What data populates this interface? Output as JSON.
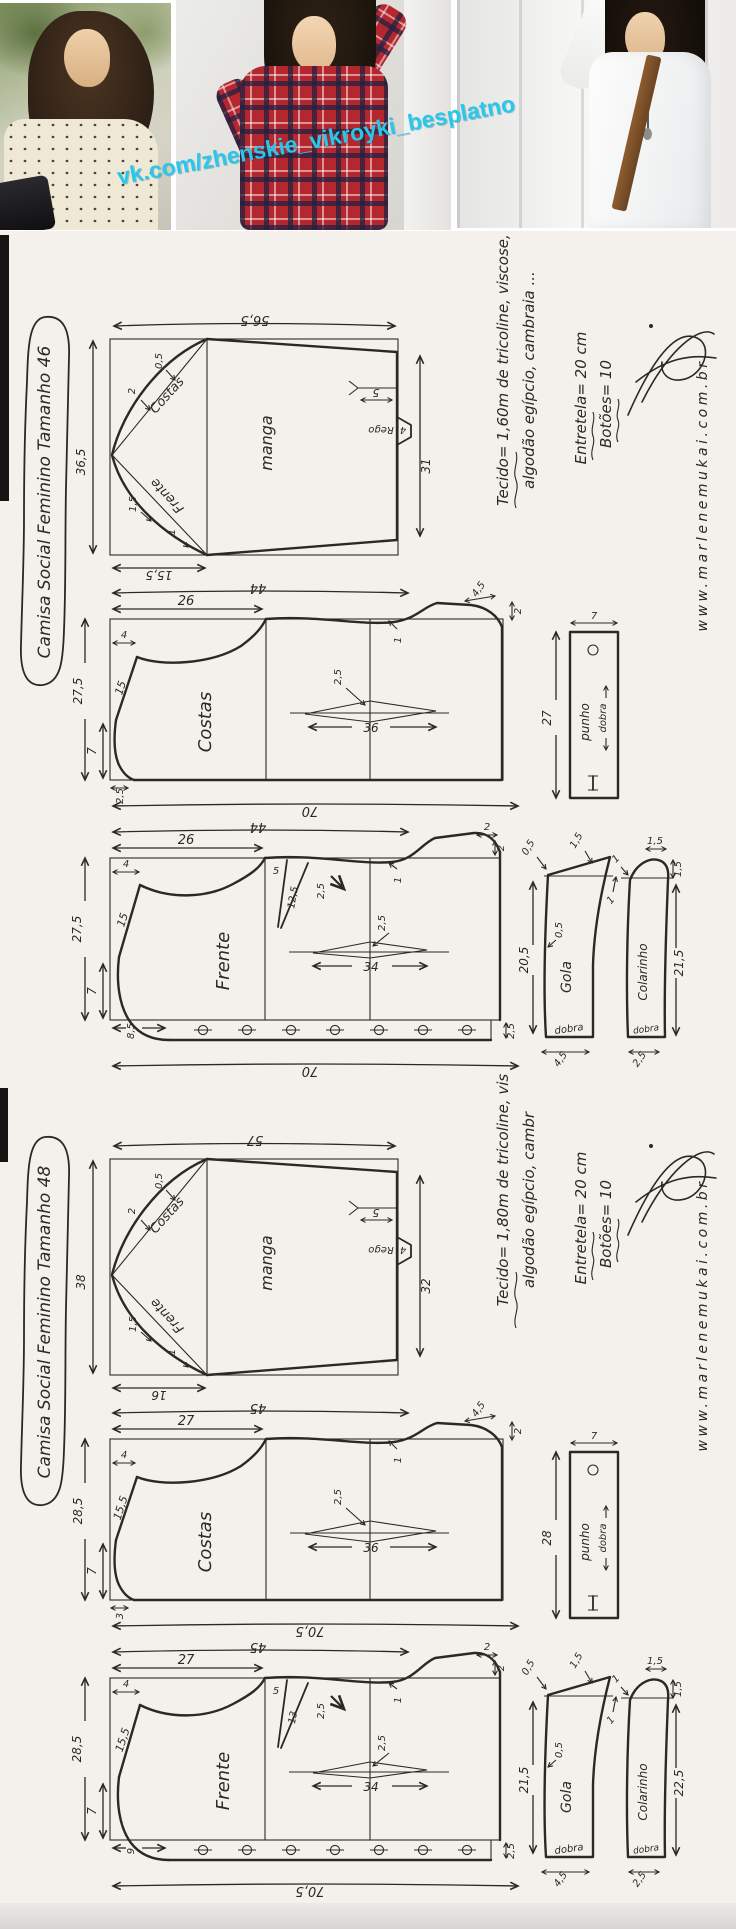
{
  "watermark": "vk.com/zhenskie_vikroyki_besplatno",
  "sections": [
    {
      "title": "Camisa Social Feminino Tamanho 46",
      "notes": {
        "fabric_line1": "Tecido= 1,60m de tricoline, viscose,",
        "fabric_line2": "algodão egípcio, cambraia ...",
        "interfacing": "Entretela= 20 cm",
        "buttons_note": "Botões= 10",
        "website": "www.marlenemukai.com.br"
      },
      "sleeve": {
        "label": "manga",
        "width_top": "56,5",
        "side_left": "36,5",
        "side_right": "31",
        "cap_bottom": "15,5",
        "slit": "5",
        "notch_label": "Rego",
        "notch": "4",
        "back_label": "Costas",
        "back_ease1": "0,5",
        "back_ease2": "2",
        "front_label": "Frente",
        "front_ease1": "1,5",
        "front_ease2": "1"
      },
      "back": {
        "label": "Costas",
        "width": "44",
        "half_width": "26",
        "length": "27,5",
        "hem_side": "7",
        "neck_drop": "4",
        "shoulder": "15",
        "wave": "1",
        "dart_depth": "2,5",
        "dart_width": "36",
        "neck_width": "2,5",
        "hem_total": "70",
        "corner_w": "4,5",
        "corner_h": "2"
      },
      "front": {
        "label": "Frente",
        "width": "44",
        "half_width": "26",
        "length": "27,5",
        "hem_side": "7",
        "neck_drop": "4",
        "shoulder": "15",
        "wave": "1",
        "neck_seg": "5",
        "neck_dart_len": "12,5",
        "neck_dart_w": "2,5",
        "dart_depth": "2,5",
        "dart_width": "34",
        "placket": "8,5",
        "band": "2,5",
        "hem_total": "70",
        "corner_w": "2",
        "corner_h": "2"
      },
      "cuff": {
        "label": "punho",
        "fold_label": "dobra",
        "length": "27",
        "width": "7"
      },
      "collar": {
        "label": "Gola",
        "fold_label": "dobra",
        "length": "20,5",
        "width": "4,5",
        "m1": "0,5",
        "m2": "1,5",
        "m3": "1",
        "m4": "0,5"
      },
      "collar_stand": {
        "label": "Colarinho",
        "fold_label": "dobra",
        "length": "21,5",
        "width": "2,5",
        "m1": "1,5",
        "m2": "1,5",
        "m3": "1"
      }
    },
    {
      "title": "Camisa Social Feminino Tamanho 48",
      "notes": {
        "fabric_line1": "Tecido= 1,80m de tricoline, vis",
        "fabric_line2": "algodão egípcio, cambr",
        "interfacing": "Entretela= 20 cm",
        "buttons_note": "Botões= 10",
        "website": "www.marlenemukai.com.br"
      },
      "sleeve": {
        "label": "manga",
        "width_top": "57",
        "side_left": "38",
        "side_right": "32",
        "cap_bottom": "16",
        "slit": "5",
        "notch_label": "Rego",
        "notch": "4",
        "back_label": "Costas",
        "back_ease1": "0,5",
        "back_ease2": "2",
        "front_label": "Frente",
        "front_ease1": "1,5",
        "front_ease2": "1"
      },
      "back": {
        "label": "Costas",
        "width": "45",
        "half_width": "27",
        "length": "28,5",
        "hem_side": "7",
        "neck_drop": "4",
        "shoulder": "15,5",
        "wave": "1",
        "dart_depth": "2,5",
        "dart_width": "36",
        "neck_width": "3",
        "hem_total": "70,5",
        "corner_w": "4,5",
        "corner_h": "2"
      },
      "front": {
        "label": "Frente",
        "width": "45",
        "half_width": "27",
        "length": "28,5",
        "hem_side": "7",
        "neck_drop": "4",
        "shoulder": "15,5",
        "wave": "1",
        "neck_seg": "5",
        "neck_dart_len": "13",
        "neck_dart_w": "2,5",
        "dart_depth": "2,5",
        "dart_width": "34",
        "placket": "9",
        "band": "2,5",
        "hem_total": "70,5",
        "corner_w": "2",
        "corner_h": "2"
      },
      "cuff": {
        "label": "punho",
        "fold_label": "dobra",
        "length": "28",
        "width": "7"
      },
      "collar": {
        "label": "Gola",
        "fold_label": "dobra",
        "length": "21,5",
        "width": "4,5",
        "m1": "0,5",
        "m2": "1,5",
        "m3": "1",
        "m4": "0,5"
      },
      "collar_stand": {
        "label": "Colarinho",
        "fold_label": "dobra",
        "length": "22,5",
        "width": "2,5",
        "m1": "1,5",
        "m2": "1,5",
        "m3": "1"
      }
    }
  ]
}
